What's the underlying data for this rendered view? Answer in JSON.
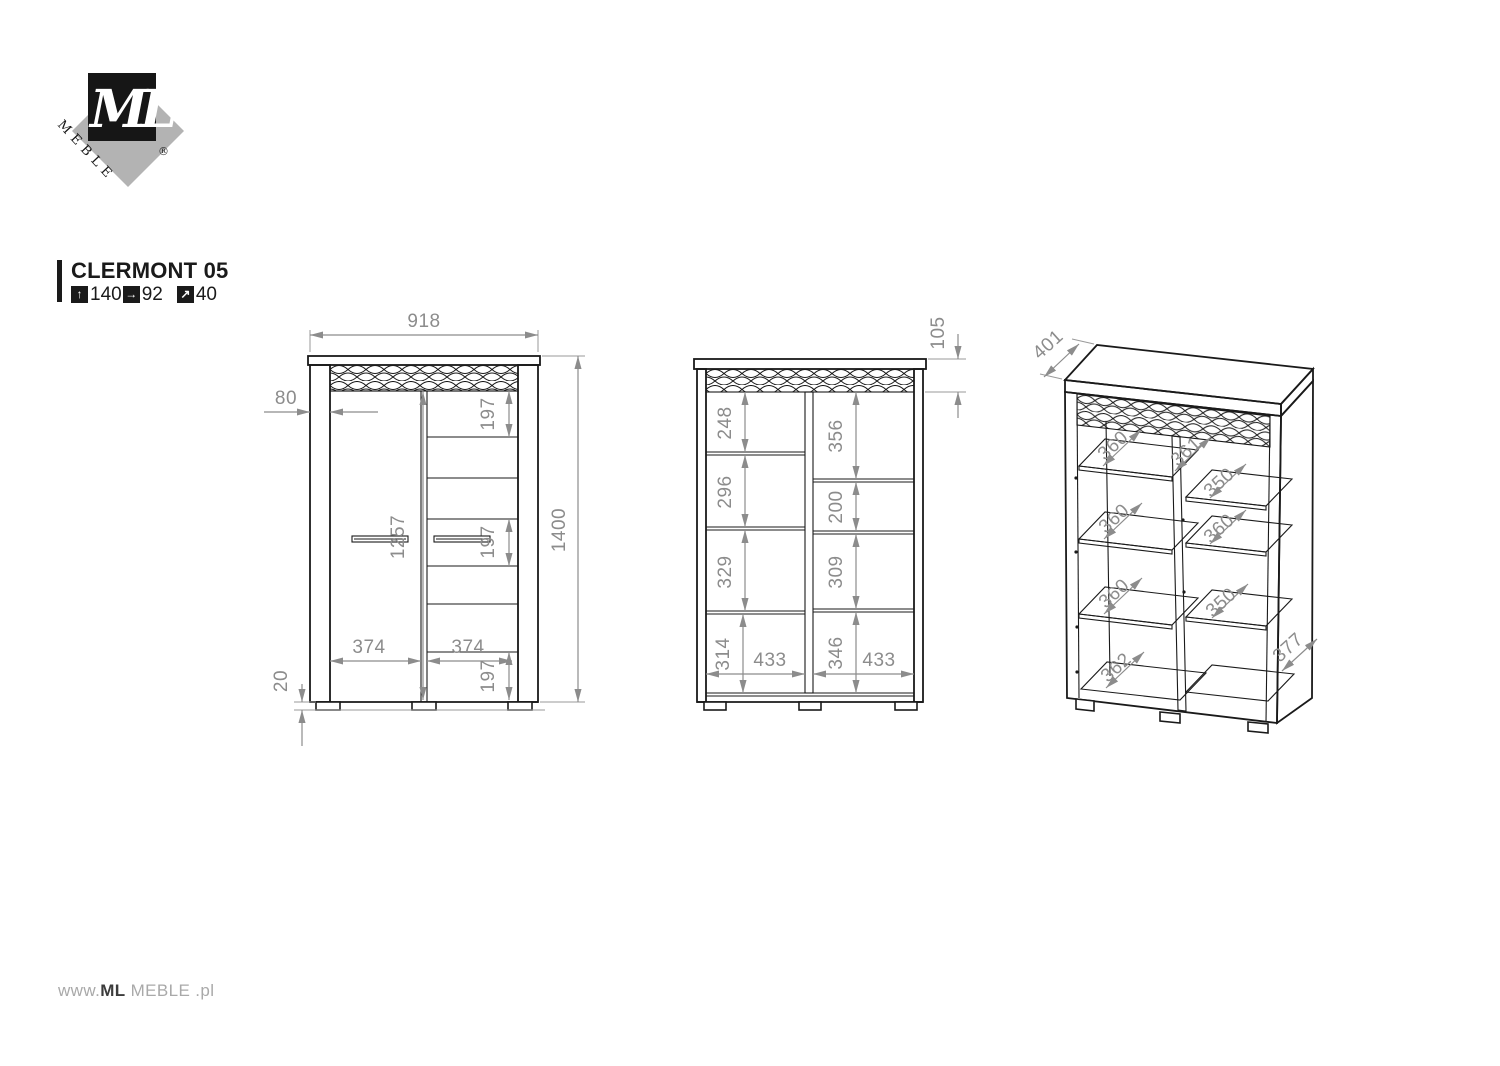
{
  "logo": {
    "ml": "ML",
    "meble": "MEBLE",
    "registered": "®"
  },
  "product": {
    "title": "CLERMONT 05",
    "dimensions": [
      {
        "icon": "arrow-up-icon",
        "glyph": "↑",
        "value": "140"
      },
      {
        "icon": "arrow-right-icon",
        "glyph": "→",
        "value": "92"
      },
      {
        "icon": "arrow-up-right-icon",
        "glyph": "↗",
        "value": "40"
      }
    ]
  },
  "front_view": {
    "total_width": "918",
    "total_height": "1400",
    "side_width": "80",
    "door_height": "1257",
    "sections": [
      "197",
      "197",
      "197"
    ],
    "left_door_width": "374",
    "right_door_width": "374",
    "foot_height": "20"
  },
  "section_view": {
    "crown_height": "105",
    "left_sections": [
      "248",
      "296",
      "329",
      "314"
    ],
    "right_sections": [
      "356",
      "200",
      "309",
      "346"
    ],
    "left_inner_width": "433",
    "right_inner_width": "433"
  },
  "perspective_view": {
    "top_depth": "401",
    "divider_depth": "361",
    "left_shelf_depths": [
      "360",
      "360",
      "360",
      "362"
    ],
    "right_shelf_depths": [
      "350",
      "360",
      "350"
    ],
    "side_depth": "377"
  },
  "footer": {
    "prefix": "www.",
    "brand": "ML",
    "suffix": "MEBLE",
    "tld": ".pl"
  },
  "colors": {
    "line": "#1a1a1a",
    "dimension": "#8c8c8c",
    "logo_gray": "#b3b3b3"
  }
}
